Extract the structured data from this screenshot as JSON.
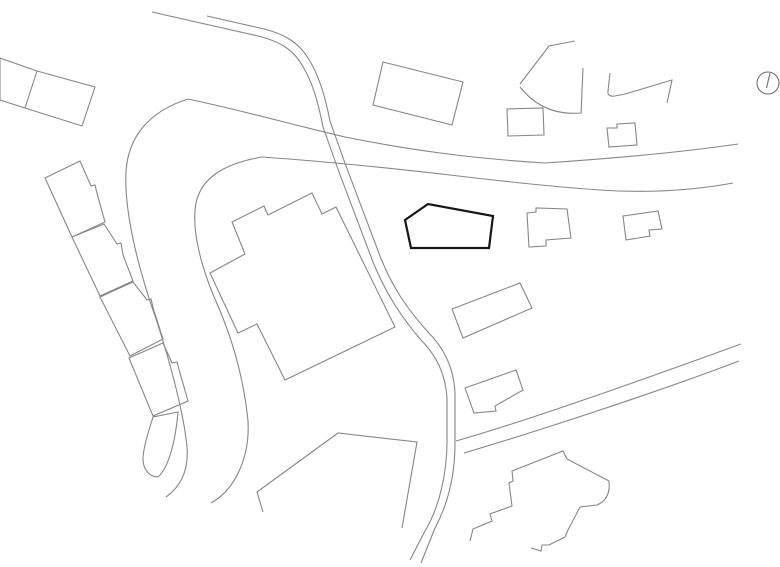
{
  "meta": {
    "description": "Black-and-white architectural site plan line drawing with roads, footpaths, surrounding buildings, a bold-outlined project building, and a north-arrow symbol",
    "canvas": {
      "width": 780,
      "height": 567
    },
    "background_color": "#ffffff"
  },
  "colors": {
    "context_line": "#868686",
    "project_line": "#161616"
  },
  "drawing": {
    "layers": [
      {
        "name": "main-road",
        "stroke": "#868686",
        "stroke_width": 1.1,
        "fill": "none",
        "paths": [
          "M 188,99 C 240,110 290,124 345,137 C 405,149 465,158 545,163 C 620,158 690,151 738,144",
          "M 733,183 C 690,191 645,193 600,190 C 555,187 500,181 450,175 C 380,167 320,161 262,157",
          "M 188,99 C 150,111 128,136 126,172 C 124,212 138,268 157,322 C 172,368 184,416 187,447 C 189,472 180,487 166,497",
          "M 262,157 C 222,164 201,179 196,203 C 191,229 201,268 218,306 C 233,341 244,381 248,421 C 250,456 236,489 211,503"
        ]
      },
      {
        "name": "footpath",
        "stroke": "#868686",
        "stroke_width": 1.1,
        "fill": "none",
        "paths": [
          "M 152,12 L 258,36 C 282,42 294,51 302,65 C 313,83 318,102 323,127 L 339,172 L 373,262 C 386,294 402,318 421,340 C 439,358 446,378 447,399 L 447,441 C 447,472 440,506 425,531 L 410,560",
          "M 207,16 L 264,29 C 288,35 300,45 308,58 C 319,75 325,96 330,121 L 346,166 L 380,256 C 392,287 408,310 428,332 C 446,350 454,371 455,393 L 455,443 C 455,472 449,502 435,528 L 421,563",
          "M 456,441 C 530,420 650,377 741,344",
          "M 464,453 C 535,432 655,393 739,361"
        ]
      },
      {
        "name": "parcel-boundary",
        "stroke": "#868686",
        "stroke_width": 1.1,
        "fill": "none",
        "paths": [
          "M 263,512 L 257,492 L 338,433 L 417,442 L 402,528"
        ]
      },
      {
        "name": "context-buildings",
        "stroke": "#868686",
        "stroke_width": 1.1,
        "fill": "none",
        "paths": [
          "M 0,58 L 37,71 L 95,87 L 82,126 L 25,108 L 0,100 Z",
          "M 37,71 L 25,108",
          "M 45,178 L 80,161 L 91,186 L 95,185 L 98,197 L 105,222 L 72,237 Z",
          "M 72,237 L 104,224 L 117,244 L 121,243 L 123,255 L 133,281 L 100,296 Z",
          "M 100,297 L 133,282 L 147,300 L 151,299 L 154,311 L 163,339 L 130,356 Z",
          "M 129,358 L 163,343 L 172,363 L 177,362 L 180,373 L 188,401 L 153,416 Z",
          "M 178,412 L 153,417 C 147,436 143,450 143,459 C 143,470 150,477 158,477 C 168,468 175,445 178,412 Z",
          "M 210,273 L 245,254 L 232,222 L 264,206 L 268,215 L 312,193 L 322,214 L 336,207 L 395,327 L 285,380 L 257,324 L 238,333 Z",
          "M 383,62 L 463,82 L 452,125 L 373,105 Z",
          "M 575,41 L 549,46 L 520,84",
          "M 520,87 Q 543,116 580,113",
          "M 583,68 L 581,114",
          "M 610,73 L 608,91 Q 607,97 615,96 L 625,94 L 672,80 L 667,103",
          "M 607,128 L 609,147 L 637,145 L 635,123 L 617,124 L 617,128 Z",
          "M 507,109 L 543,108 L 544,135 L 508,136 Z",
          "M 527,213 L 536,212 L 536,208 L 567,209 L 571,238 L 546,240 L 546,246 L 529,247 Z",
          "M 623,216 L 658,211 L 662,229 L 649,230 L 650,236 L 626,240 Z",
          "M 452,309 L 520,283 L 532,308 L 463,338 Z",
          "M 465,388 L 516,370 L 523,390 L 495,406 L 496,411 L 474,413 Z",
          "M 470,541 L 473,529 L 492,521 L 490,514 L 512,506 L 509,483 L 513,481 L 512,471 L 563,451 L 567,459 L 609,481 Q 611,499 597,505 L 580,507 L 568,530 L 565,537 L 549,545 L 542,545 L 541,551 L 531,548"
        ]
      },
      {
        "name": "project-building",
        "stroke": "#161616",
        "stroke_width": 2.2,
        "fill": "none",
        "paths": [
          "M 405,220 L 428,204 L 493,216 L 489,248 L 411,248 Z"
        ]
      },
      {
        "name": "north-arrow-icon",
        "stroke": "#6e6e6e",
        "stroke_width": 1.1,
        "fill": "none",
        "paths": [
          "M 757,83 a 11,11 0 1 0 22,0 a 11,11 0 1 0 -22,0",
          "M 770,73 L 766.5,88"
        ]
      }
    ]
  }
}
